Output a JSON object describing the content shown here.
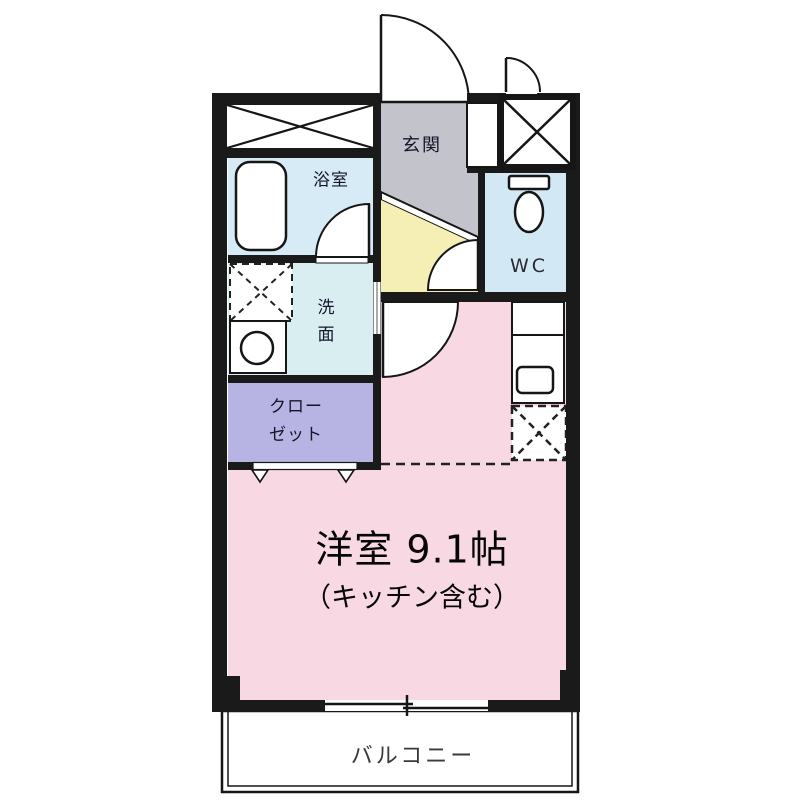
{
  "plan": {
    "title": "apartment-floor-plan",
    "rooms": {
      "genkan": {
        "label": "玄関"
      },
      "bathroom": {
        "label": "浴室"
      },
      "washroom": {
        "label": "洗面"
      },
      "closet": {
        "label_line1": "クロー",
        "label_line2": "ゼット"
      },
      "wc": {
        "label": "WC"
      },
      "main_room": {
        "label": "洋室 9.1帖",
        "sublabel": "（キッチン含む）"
      },
      "balcony": {
        "label": "バルコニー"
      }
    },
    "colors": {
      "wall": "#1a1a1a",
      "genkan": "#c3c3cb",
      "step": "#ffffff",
      "hall": "#f6efb5",
      "bathroom": "#d6ebf5",
      "washroom": "#d9eef1",
      "wc": "#d2e8f4",
      "closet": "#b7b3e2",
      "main_room": "#f8d9e3",
      "balcony": "#ffffff"
    }
  }
}
